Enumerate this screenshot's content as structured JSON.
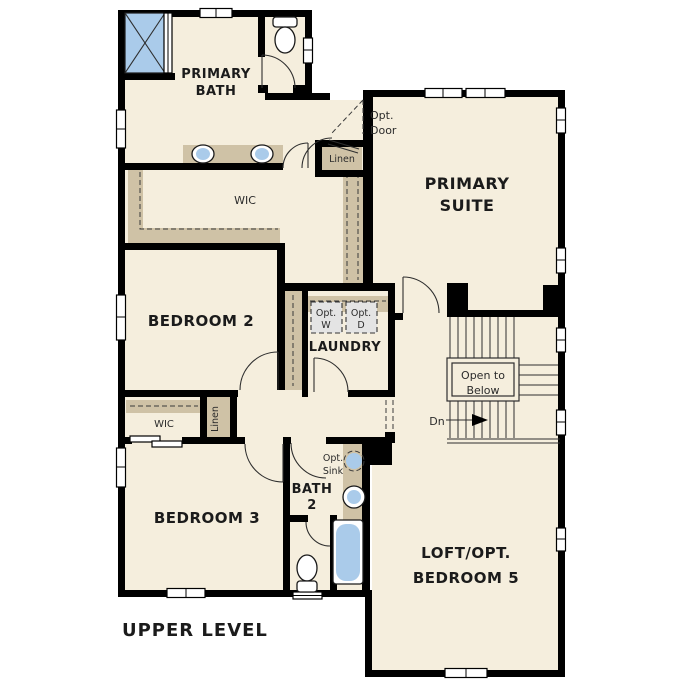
{
  "plan": {
    "title": "UPPER LEVEL",
    "level": "Upper Level floor plan"
  },
  "rooms": {
    "primary_bath": {
      "name_line1": "PRIMARY",
      "name_line2": "BATH"
    },
    "primary_suite": {
      "name_line1": "PRIMARY",
      "name_line2": "SUITE"
    },
    "wic_primary": {
      "name": "WIC"
    },
    "linen_primary": {
      "name": "Linen"
    },
    "bedroom2": {
      "name": "BEDROOM 2"
    },
    "laundry": {
      "name": "LAUNDRY"
    },
    "wic_bedroom3": {
      "name": "WIC"
    },
    "linen_hall": {
      "name": "Linen"
    },
    "bedroom3": {
      "name": "BEDROOM 3"
    },
    "bath2": {
      "name_line1": "BATH",
      "name_line2": "2"
    },
    "loft": {
      "name_line1": "LOFT/OPT.",
      "name_line2": "BEDROOM 5"
    }
  },
  "annotations": {
    "opt_door_line1": "Opt.",
    "opt_door_line2": "Door",
    "opt_washer_line1": "Opt.",
    "opt_washer_line2": "W",
    "opt_dryer_line1": "Opt.",
    "opt_dryer_line2": "D",
    "open_to_below_line1": "Open to",
    "open_to_below_line2": "Below",
    "stair_direction": "Dn",
    "opt_sink_line1": "Opt.",
    "opt_sink_line2": "Sink"
  },
  "colors": {
    "background": "#ffffff",
    "floor": "#f5eedd",
    "wall": "#000000",
    "casework_tan": "#cfc2a6",
    "fixture_blue": "#aacbea",
    "appliance_gray": "#e4e4e4",
    "text": "#1b1b1b"
  }
}
